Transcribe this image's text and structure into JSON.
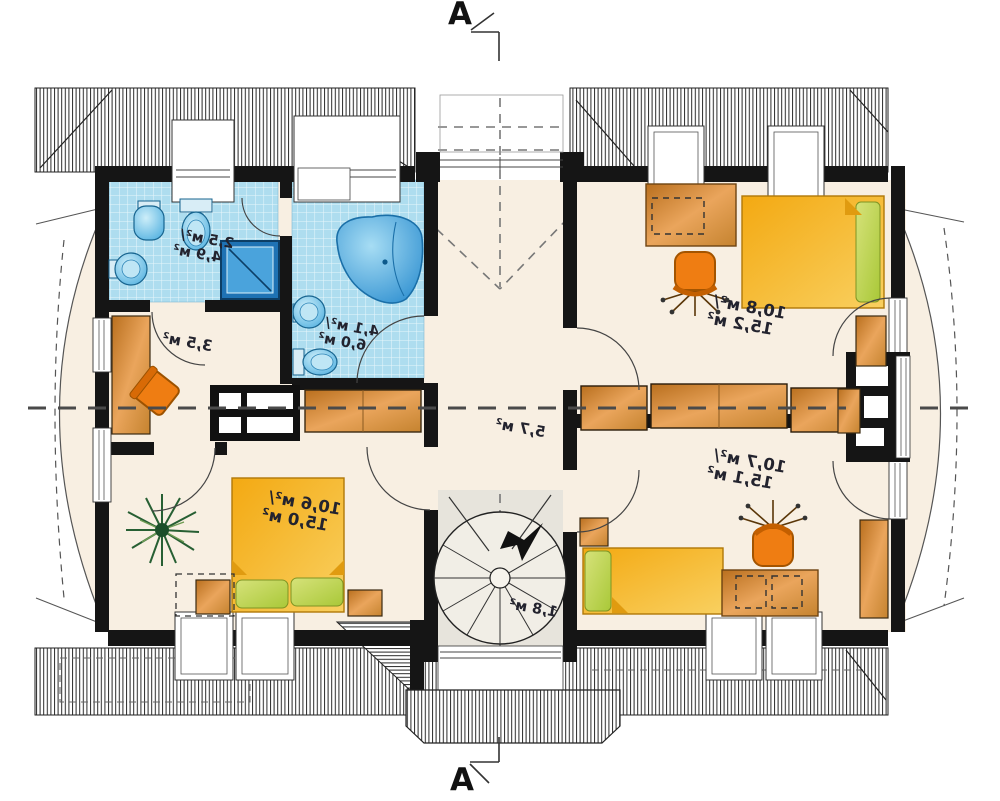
{
  "title": "Mirrored attic floor plan with section line A-A",
  "section_markers": {
    "top": "A",
    "bottom": "A"
  },
  "rooms": [
    {
      "name": "wc",
      "line1": "2,5 м²/",
      "line2": "4,9 м²"
    },
    {
      "name": "bathroom",
      "line1": "4,1 м²/",
      "line2": "6,0 м²"
    },
    {
      "name": "closet",
      "line1": "3,5 м²",
      "line2": ""
    },
    {
      "name": "hall",
      "line1": "5,7 м²",
      "line2": ""
    },
    {
      "name": "staircase",
      "line1": "1,8 м²",
      "line2": ""
    },
    {
      "name": "bedroom-top-right",
      "line1": "10,8 м²/",
      "line2": "15,2 м²"
    },
    {
      "name": "bedroom-bottom-right",
      "line1": "10,7 м²/",
      "line2": "15,1 м²"
    },
    {
      "name": "bedroom-bottom-left",
      "line1": "10,6 м²/",
      "line2": "15,0 м²"
    }
  ],
  "colors": {
    "wall": "#151515",
    "floor": "#f8efe2",
    "tile_background": "#aeddef",
    "fixture_blue": "#3fa7dc",
    "shower_dark_blue": "#1e72b4",
    "wood_furniture": "#d98f3e",
    "bed_yellow": "#f5b31c",
    "pillow_green": "#bcd45c",
    "office_chair_orange": "#ef7d12",
    "stair_floor": "#e7e4dc",
    "hatch_line": "#2a2a2a",
    "dash_line": "#4a4a4a"
  }
}
